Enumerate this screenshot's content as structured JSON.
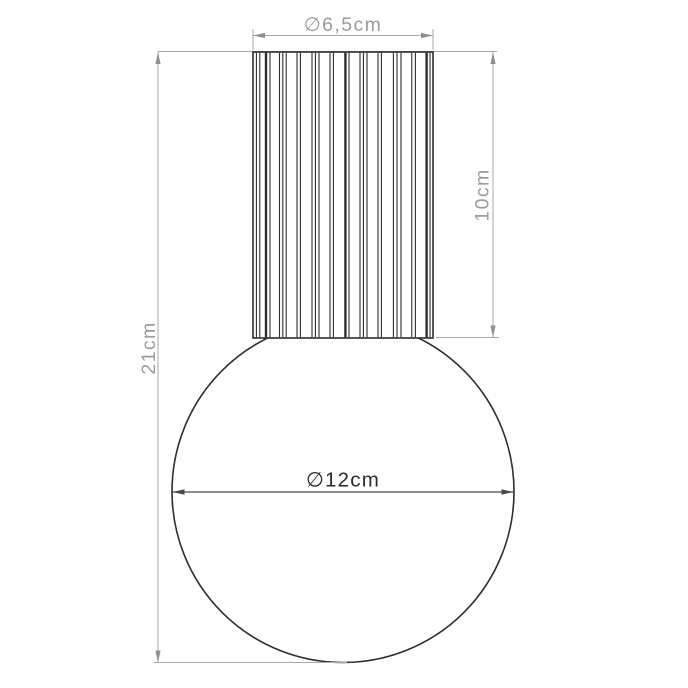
{
  "drawing": {
    "labels": {
      "top_diameter": "∅6,5cm",
      "neck_height": "10cm",
      "total_height": "21cm",
      "sphere_diameter": "∅12cm"
    },
    "colors": {
      "background": "#ffffff",
      "outline": "#2e2e2e",
      "dimension_line": "#a9a9a9",
      "dimension_arrow": "#8f8f8f",
      "dimension_text": "#9b9b9b",
      "diameter_line": "#4a4a4a",
      "diameter_text": "#2b2b2b"
    }
  }
}
